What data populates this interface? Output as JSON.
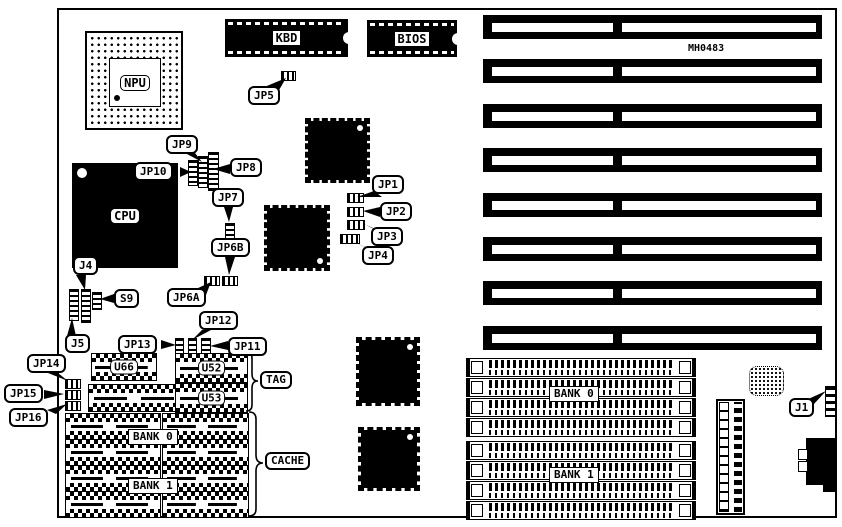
{
  "board": {
    "part_number": "MH0483"
  },
  "chips": {
    "npu": "NPU",
    "cpu": "CPU",
    "kbd": "KBD",
    "bios": "BIOS",
    "u66": "U66",
    "u52": "U52",
    "u53": "U53"
  },
  "region_labels": {
    "tag": "TAG",
    "cache": "CACHE",
    "cache_bank0": "BANK 0",
    "cache_bank1": "BANK 1",
    "simm_bank0": "BANK 0",
    "simm_bank1": "BANK 1"
  },
  "callouts": {
    "jp1": "JP1",
    "jp2": "JP2",
    "jp3": "JP3",
    "jp4": "JP4",
    "jp5": "JP5",
    "jp6a": "JP6A",
    "jp6b": "JP6B",
    "jp7": "JP7",
    "jp8": "JP8",
    "jp9": "JP9",
    "jp10": "JP10",
    "jp11": "JP11",
    "jp12": "JP12",
    "jp13": "JP13",
    "jp14": "JP14",
    "jp15": "JP15",
    "jp16": "JP16",
    "j1": "J1",
    "j4": "J4",
    "j5": "J5",
    "s9": "S9"
  },
  "layout_counts": {
    "isa_slots": 8,
    "simm_sockets_per_bank": 4,
    "cache_socket_rows": 4,
    "cache_socket_cols": 2
  },
  "colors": {
    "ink": "#000000",
    "paper": "#ffffff"
  }
}
